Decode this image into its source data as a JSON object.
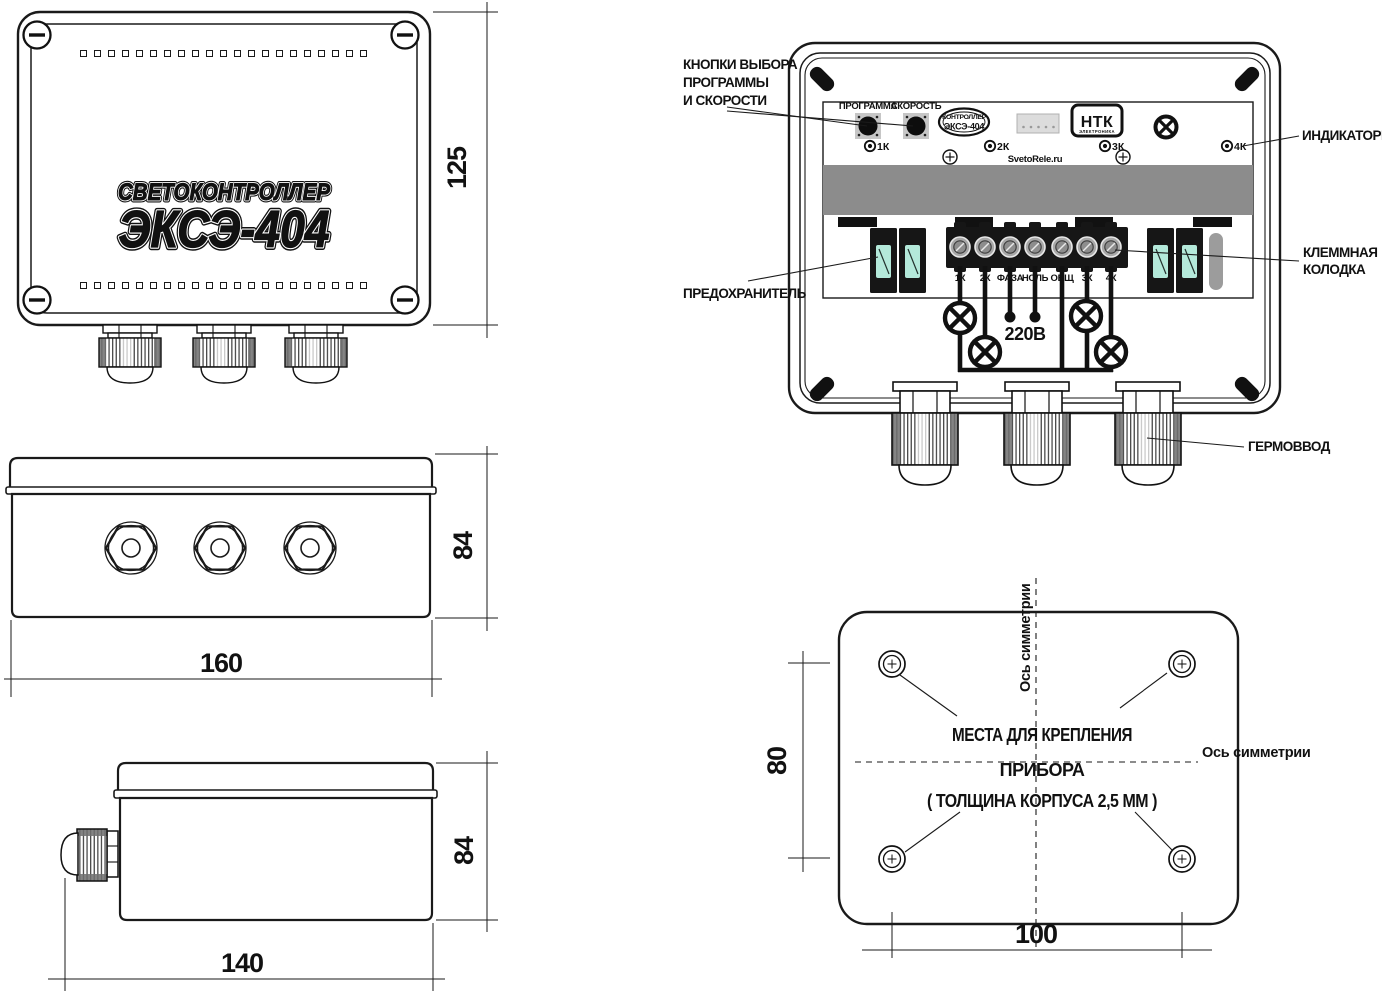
{
  "front_view": {
    "logo_line1": "СВЕТОКОНТРОЛЛЕР",
    "logo_line2": "ЭКСЭ-404",
    "dim_height": "125"
  },
  "internal_view": {
    "button_labels": [
      "ПРОГРАММА",
      "СКОРОСТЬ"
    ],
    "badge_line1": "КОНТРОЛЛЕР",
    "badge_line2": "ЭКСЭ-404",
    "brand": "НТК",
    "brand_sub": "ЭЛЕКТРОНИКА",
    "site": "SvetoRele.ru",
    "indicators": [
      "1К",
      "2К",
      "3К",
      "4К"
    ],
    "terminals": [
      "1К",
      "2К",
      "ФАЗА",
      "НОЛЬ",
      "ОБЩ",
      "3К",
      "4К"
    ],
    "voltage": "220В",
    "callout_buttons": [
      "КНОПКИ ВЫБОРА",
      "ПРОГРАММЫ",
      "И СКОРОСТИ"
    ],
    "callout_fuse": "ПРЕДОХРАНИТЕЛЬ",
    "callout_indicators": "ИНДИКАТОРЫ",
    "callout_terminal": [
      "КЛЕММНАЯ",
      "КОЛОДКА"
    ],
    "callout_gland": "ГЕРМОВВОД"
  },
  "bottom_view": {
    "dim_width": "160",
    "dim_depth": "84"
  },
  "side_view": {
    "dim_width": "140",
    "dim_depth": "84"
  },
  "mounting_view": {
    "axis_vertical": "Ось симметрии",
    "axis_horizontal": "Ось симметрии",
    "note_line1": "МЕСТА ДЛЯ КРЕПЛЕНИЯ",
    "note_line2": "ПРИБОРА",
    "note_line3": "( ТОЛЩИНА КОРПУСА 2,5 ММ )",
    "dim_vertical": "80",
    "dim_horizontal": "100"
  },
  "colors": {
    "line": "#1a1a1a",
    "band_gray": "#8c8c8c",
    "fuse_window": "#b4e9da",
    "capsule_gray": "#9c9c9c",
    "connector_gray": "#dcdcdc"
  }
}
